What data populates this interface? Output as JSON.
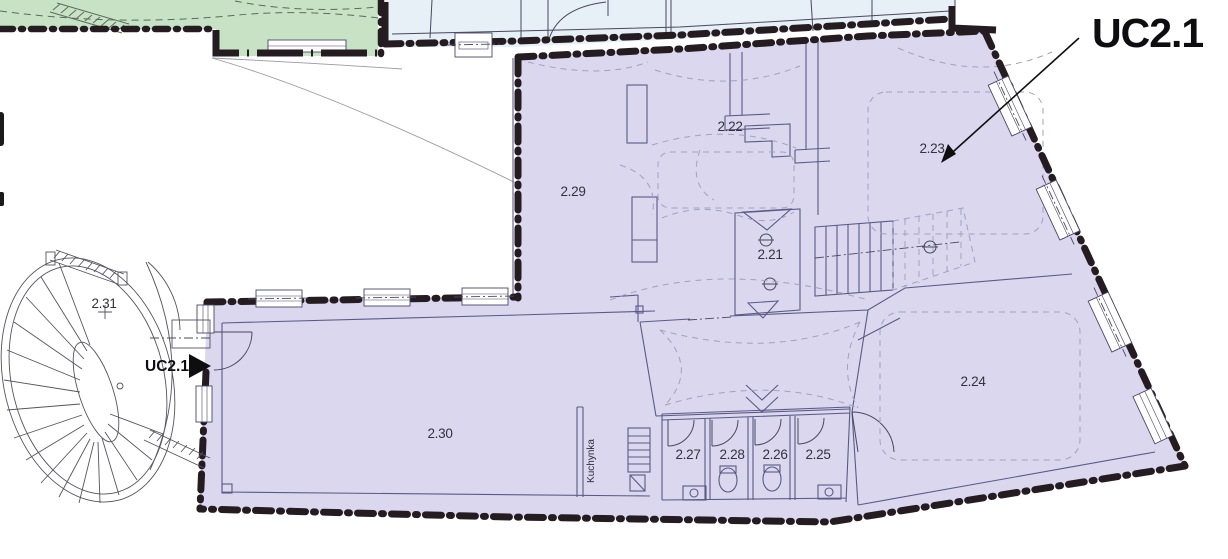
{
  "plan": {
    "title_context": "Floor plan with highlighted unit",
    "unit_annotation": "UC2.1",
    "entry_marker": "UC2.1",
    "kitchen_label": "Kuchynka",
    "rooms": [
      "2.21",
      "2.22",
      "2.23",
      "2.24",
      "2.25",
      "2.26",
      "2.27",
      "2.28",
      "2.29",
      "2.30",
      "2.31"
    ],
    "colors": {
      "unit_fill": "#dad7ef",
      "adjacent_green_fill": "#c7e2c4",
      "adjacent_blue_fill": "#e6f0f6",
      "wall": "#241c21",
      "interior_line": "#5c5a85",
      "label": "#34323e",
      "annotation": "#0e0e10"
    }
  }
}
